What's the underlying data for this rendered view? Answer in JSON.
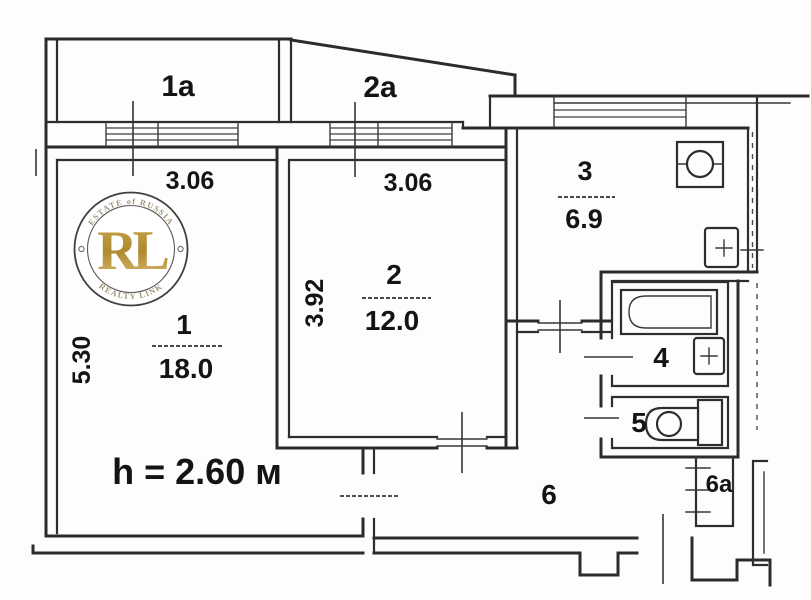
{
  "plan": {
    "balcony_1a": {
      "label": "1a",
      "dim": "3.06"
    },
    "balcony_2a": {
      "label": "2a",
      "dim": "3.06"
    },
    "room_1": {
      "label": "1",
      "area": "18.0",
      "dim": "5.30"
    },
    "room_2": {
      "label": "2",
      "area": "12.0",
      "dim": "3.92"
    },
    "room_3": {
      "label": "3",
      "area": "6.9"
    },
    "room_4": {
      "label": "4"
    },
    "room_5": {
      "label": "5"
    },
    "room_6": {
      "label": "6"
    },
    "room_6a": {
      "label": "6a"
    },
    "ceiling_height": "h = 2.60 м"
  },
  "watermark": {
    "arc_top": "ESTATE of RUSSIA",
    "monogram": "RL",
    "arc_bottom": "REALTY LINK"
  },
  "colors": {
    "line": "#2b2b2b",
    "text": "#141414",
    "watermark_gold": "#bd9640",
    "watermark_gray": "#a09378",
    "background": "#fdfdfc"
  }
}
